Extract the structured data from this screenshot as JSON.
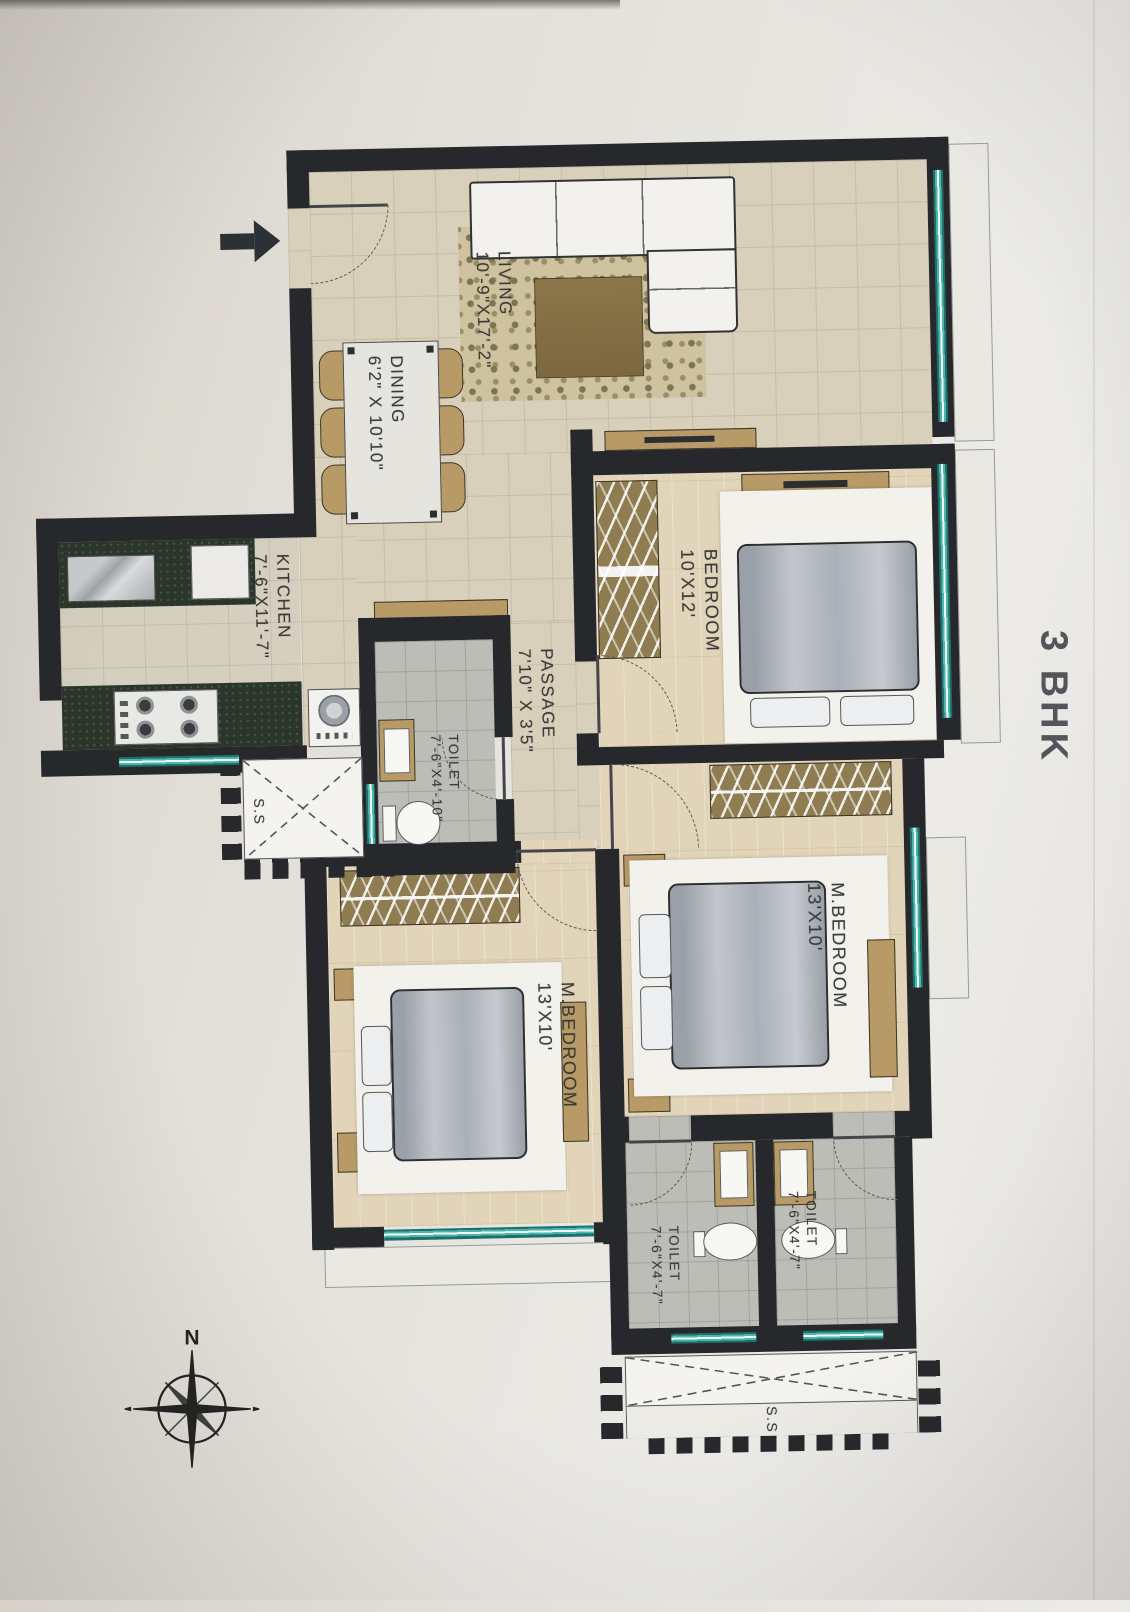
{
  "title": {
    "text": "3 BHK"
  },
  "compass": {
    "north_label": "N"
  },
  "rooms": {
    "living": {
      "name": "LIVING",
      "dim": "10'-9\"X17'-2\""
    },
    "dining": {
      "name": "DINING",
      "dim": "6'2\" X 10'10\""
    },
    "kitchen": {
      "name": "KITCHEN",
      "dim": "7'-6\"X11'-7\""
    },
    "passage": {
      "name": "PASSAGE",
      "dim": "7'10\" X 3'5\""
    },
    "bedroom": {
      "name": "BEDROOM",
      "dim": "10'X12'"
    },
    "master_bedroom_right": {
      "name": "M.BEDROOM",
      "dim": "13'X10'"
    },
    "master_bedroom_left": {
      "name": "M.BEDROOM",
      "dim": "13'X10'"
    },
    "toilet_passage": {
      "name": "TOILET",
      "dim": "7'-6\"X4'-10\""
    },
    "toilet_bottom_left": {
      "name": "TOILET",
      "dim": "7'-6\"X4'-7\""
    },
    "toilet_bottom_right": {
      "name": "TOILET",
      "dim": "7'-6\"X4'-7\""
    },
    "service_slab_kitchen": {
      "name": "S.S"
    },
    "service_slab_bottom": {
      "name": "S.S"
    }
  },
  "colors": {
    "wall": "#26282b",
    "window_teal": "#2f9f9a",
    "floor_beige": "#d8d0bb",
    "floor_wood": "#e1d4b9",
    "floor_toilet": "#bdbdb7",
    "counter_granite": "#2b362a",
    "furniture_tan": "#b79a66",
    "paper": "#e4e1da",
    "label_text": "#3a3a38"
  }
}
